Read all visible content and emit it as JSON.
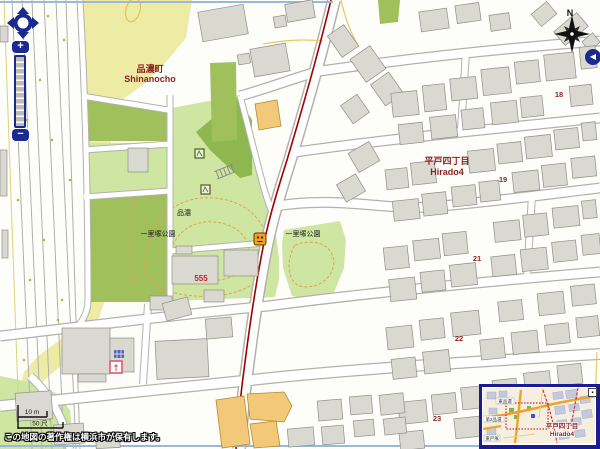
{
  "map": {
    "labels": {
      "town_left_jp": "品濃町",
      "town_left_en": "Shinanocho",
      "town_right_jp": "平戸四丁目",
      "town_right_en": "Hirado4",
      "park_name_left": "一里塚公園",
      "park_name_right": "一里塚公園",
      "park_small_label": "品濃",
      "building_number": "555",
      "block_numbers": [
        "18",
        "19",
        "21",
        "22",
        "23"
      ]
    },
    "icons": {
      "playground": "playground-icon",
      "poi_marker": "poi-marker-icon",
      "facility_blue": "facility-icon-blue",
      "facility_pink": "facility-icon-pink",
      "stairs": "stairs-icon",
      "compass": "compass-rose-icon",
      "pan": "pan-arrows-icon"
    },
    "colors": {
      "district_label": "#8b1f1f",
      "block_number": "#8b1f1f",
      "building_number_red": "#c42222",
      "park_light": "#cfe6a2",
      "park_medium": "#9fc05a",
      "park_dark": "#8fb750",
      "zone_yellow": "#eeeca4",
      "building_fill": "#d9d9d2",
      "building_orange": "#f2c979",
      "road_red_line": "#a00000",
      "contour_orange": "#e0a050",
      "control_navy": "#1b2a8f",
      "minimap_border": "#1b1b96",
      "boundary_blue": "#9ab8dc"
    }
  },
  "controls": {
    "compass_north": "N",
    "zoom_in": "+",
    "zoom_out": "−",
    "panel_collapse": "◀"
  },
  "scalebar": {
    "metric": "10 m",
    "shaku": "50 尺"
  },
  "minimap": {
    "town_jp": "平戸四丁目",
    "town_en": "Hirado4",
    "place_labels": [
      "東品濃",
      "第2品濃",
      "東戸塚"
    ],
    "collapse_glyph": "▪"
  },
  "footer": {
    "copyright": "この地図の著作権は横浜市が保有します。"
  }
}
